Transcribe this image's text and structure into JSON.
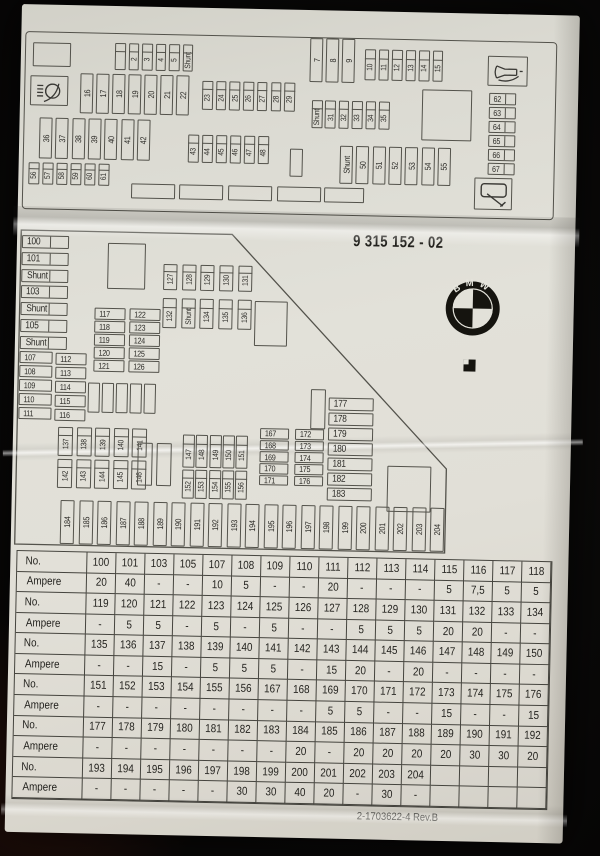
{
  "part_number": "9 315 152 - 02",
  "brand_logo": {
    "letters": "BMW"
  },
  "footer_code": "2-1703622-4 Rev.B",
  "top_diagram": {
    "icons": [
      "headlight-washer",
      "horn",
      "wiper"
    ],
    "fuse_groups": {
      "row_1_5": [
        "",
        "2",
        "3",
        "4",
        "5",
        "Shunt"
      ],
      "row_7_9": [
        "7",
        "8",
        "9"
      ],
      "row_10_15": [
        "10",
        "11",
        "12",
        "13",
        "14",
        "15"
      ],
      "row_16_22": [
        "16",
        "17",
        "18",
        "19",
        "20",
        "21",
        "22"
      ],
      "row_23_29": [
        "23",
        "24",
        "25",
        "26",
        "27",
        "28",
        "29"
      ],
      "row_31_35": [
        "Shunt",
        "31",
        "32",
        "33",
        "34",
        "35"
      ],
      "col_62_67": [
        "62",
        "63",
        "64",
        "65",
        "66",
        "67"
      ],
      "row_36_42": [
        "36",
        "37",
        "38",
        "39",
        "40",
        "41",
        "42"
      ],
      "row_43_48": [
        "43",
        "44",
        "45",
        "46",
        "47",
        "48"
      ],
      "row_50_55": [
        "Shunt",
        "50",
        "51",
        "52",
        "53",
        "54",
        "55"
      ],
      "row_56_61": [
        "56",
        "57",
        "58",
        "59",
        "60",
        "61"
      ]
    }
  },
  "middle_diagram": {
    "fuse_groups": {
      "col_100_105": [
        "100",
        "101",
        "Shunt",
        "103",
        "Shunt",
        "105",
        "Shunt"
      ],
      "col_107_111": [
        "107",
        "108",
        "109",
        "110",
        "111"
      ],
      "col_112_116": [
        "112",
        "113",
        "114",
        "115",
        "116"
      ],
      "col_117_121": [
        "117",
        "118",
        "119",
        "120",
        "121"
      ],
      "col_122_126": [
        "122",
        "123",
        "124",
        "125",
        "126"
      ],
      "row_127_131": [
        "127",
        "128",
        "129",
        "130",
        "131"
      ],
      "row_132_136": [
        "132",
        "Shunt",
        "134",
        "135",
        "136"
      ],
      "row_137_141": [
        "137",
        "138",
        "139",
        "140",
        "141"
      ],
      "row_142_146": [
        "142",
        "143",
        "144",
        "145",
        "146"
      ],
      "row_147_151": [
        "147",
        "148",
        "149",
        "150",
        "151"
      ],
      "row_152_156": [
        "152",
        "153",
        "154",
        "155",
        "156"
      ],
      "col_167_171": [
        "167",
        "168",
        "169",
        "170",
        "171"
      ],
      "col_172_176": [
        "172",
        "173",
        "174",
        "175",
        "176"
      ],
      "col_177_183": [
        "177",
        "178",
        "179",
        "180",
        "181",
        "182",
        "183"
      ],
      "row_184_204": [
        "184",
        "185",
        "186",
        "187",
        "188",
        "189",
        "190",
        "191",
        "192",
        "193",
        "194",
        "195",
        "196",
        "197",
        "198",
        "199",
        "200",
        "201",
        "202",
        "203",
        "204"
      ]
    }
  },
  "amperage_table": {
    "rows": [
      {
        "label": "No.",
        "cells": [
          "100",
          "101",
          "103",
          "105",
          "107",
          "108",
          "109",
          "110",
          "111",
          "112",
          "113",
          "114",
          "115",
          "116",
          "117",
          "118"
        ]
      },
      {
        "label": "Ampere",
        "cells": [
          "20",
          "40",
          "-",
          "-",
          "10",
          "5",
          "-",
          "-",
          "20",
          "-",
          "-",
          "-",
          "5",
          "7,5",
          "5",
          "5"
        ]
      },
      {
        "label": "No.",
        "cells": [
          "119",
          "120",
          "121",
          "122",
          "123",
          "124",
          "125",
          "126",
          "127",
          "128",
          "129",
          "130",
          "131",
          "132",
          "133",
          "134"
        ]
      },
      {
        "label": "Ampere",
        "cells": [
          "-",
          "5",
          "5",
          "-",
          "5",
          "-",
          "5",
          "-",
          "-",
          "5",
          "5",
          "5",
          "20",
          "20",
          "-",
          "-"
        ]
      },
      {
        "label": "No.",
        "cells": [
          "135",
          "136",
          "137",
          "138",
          "139",
          "140",
          "141",
          "142",
          "143",
          "144",
          "145",
          "146",
          "147",
          "148",
          "149",
          "150"
        ]
      },
      {
        "label": "Ampere",
        "cells": [
          "-",
          "-",
          "15",
          "-",
          "5",
          "5",
          "5",
          "-",
          "15",
          "20",
          "-",
          "20",
          "-",
          "-",
          "-",
          "-"
        ]
      },
      {
        "label": "No.",
        "cells": [
          "151",
          "152",
          "153",
          "154",
          "155",
          "156",
          "167",
          "168",
          "169",
          "170",
          "171",
          "172",
          "173",
          "174",
          "175",
          "176"
        ]
      },
      {
        "label": "Ampere",
        "cells": [
          "-",
          "-",
          "-",
          "-",
          "-",
          "-",
          "-",
          "-",
          "5",
          "5",
          "-",
          "-",
          "15",
          "-",
          "-",
          "15"
        ]
      },
      {
        "label": "No.",
        "cells": [
          "177",
          "178",
          "179",
          "180",
          "181",
          "182",
          "183",
          "184",
          "185",
          "186",
          "187",
          "188",
          "189",
          "190",
          "191",
          "192"
        ]
      },
      {
        "label": "Ampere",
        "cells": [
          "-",
          "-",
          "-",
          "-",
          "-",
          "-",
          "-",
          "20",
          "-",
          "20",
          "20",
          "20",
          "20",
          "30",
          "30",
          "20"
        ]
      },
      {
        "label": "No.",
        "cells": [
          "193",
          "194",
          "195",
          "196",
          "197",
          "198",
          "199",
          "200",
          "201",
          "202",
          "203",
          "204",
          "",
          "",
          "",
          ""
        ]
      },
      {
        "label": "Ampere",
        "cells": [
          "-",
          "-",
          "-",
          "-",
          "-",
          "30",
          "30",
          "40",
          "20",
          "-",
          "30",
          "-",
          "",
          "",
          "",
          ""
        ]
      }
    ]
  }
}
